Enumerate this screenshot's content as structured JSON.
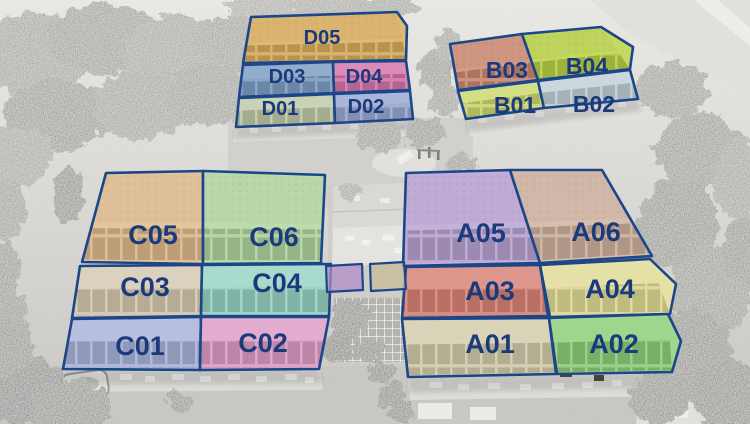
{
  "scene": {
    "outline_color": "#1c468a",
    "label_color": "#1a3a7c"
  },
  "units": {
    "D05": {
      "label": "D05",
      "color": "#d9a648"
    },
    "D03": {
      "label": "D03",
      "color": "#6f94c4"
    },
    "D04": {
      "label": "D04",
      "color": "#d765a8"
    },
    "D01": {
      "label": "D01",
      "color": "#bcc9a2"
    },
    "D02": {
      "label": "D02",
      "color": "#8fa2d6"
    },
    "B03": {
      "label": "B03",
      "color": "#c97c60"
    },
    "B04": {
      "label": "B04",
      "color": "#b3d12f"
    },
    "B01": {
      "label": "B01",
      "color": "#ccdb60"
    },
    "B02": {
      "label": "B02",
      "color": "#bfd0da"
    },
    "C05": {
      "label": "C05",
      "color": "#e0b581"
    },
    "C06": {
      "label": "C06",
      "color": "#abd598"
    },
    "C03": {
      "label": "C03",
      "color": "#d7c8ac"
    },
    "C04": {
      "label": "C04",
      "color": "#8fd4c4"
    },
    "C01": {
      "label": "C01",
      "color": "#a3aede"
    },
    "C02": {
      "label": "C02",
      "color": "#e194c6"
    },
    "A05": {
      "label": "A05",
      "color": "#b49ad2"
    },
    "A06": {
      "label": "A06",
      "color": "#cdab96"
    },
    "A03": {
      "label": "A03",
      "color": "#da7468"
    },
    "A04": {
      "label": "A04",
      "color": "#e3dc8c"
    },
    "A01": {
      "label": "A01",
      "color": "#d3cca6"
    },
    "A02": {
      "label": "A02",
      "color": "#82cf6c"
    }
  },
  "extras": {
    "terrace_patch_1_color": "#b48cc8",
    "terrace_patch_2_color": "#c8bb94"
  }
}
